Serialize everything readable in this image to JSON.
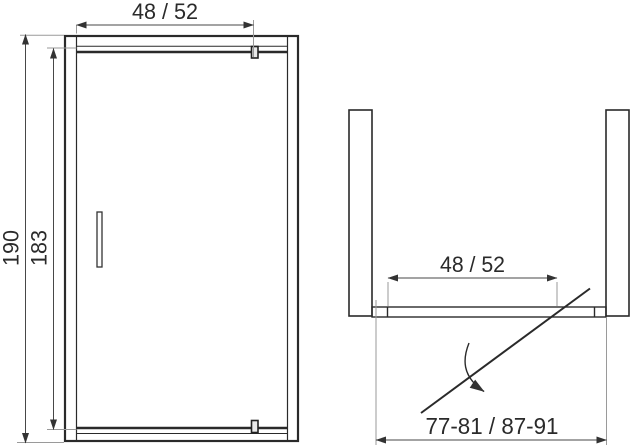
{
  "drawing": {
    "front_view": {
      "door_width_label": "48 / 52",
      "total_height_label": "190",
      "door_leaf_height_label": "183"
    },
    "top_view": {
      "door_width_label": "48 / 52",
      "installation_range_label": "77-81 / 87-91"
    },
    "colors": {
      "line": "#2a2a2a",
      "dimension_line": "#474747",
      "extension_line": "#9a9a9a",
      "background": "#ffffff"
    }
  }
}
